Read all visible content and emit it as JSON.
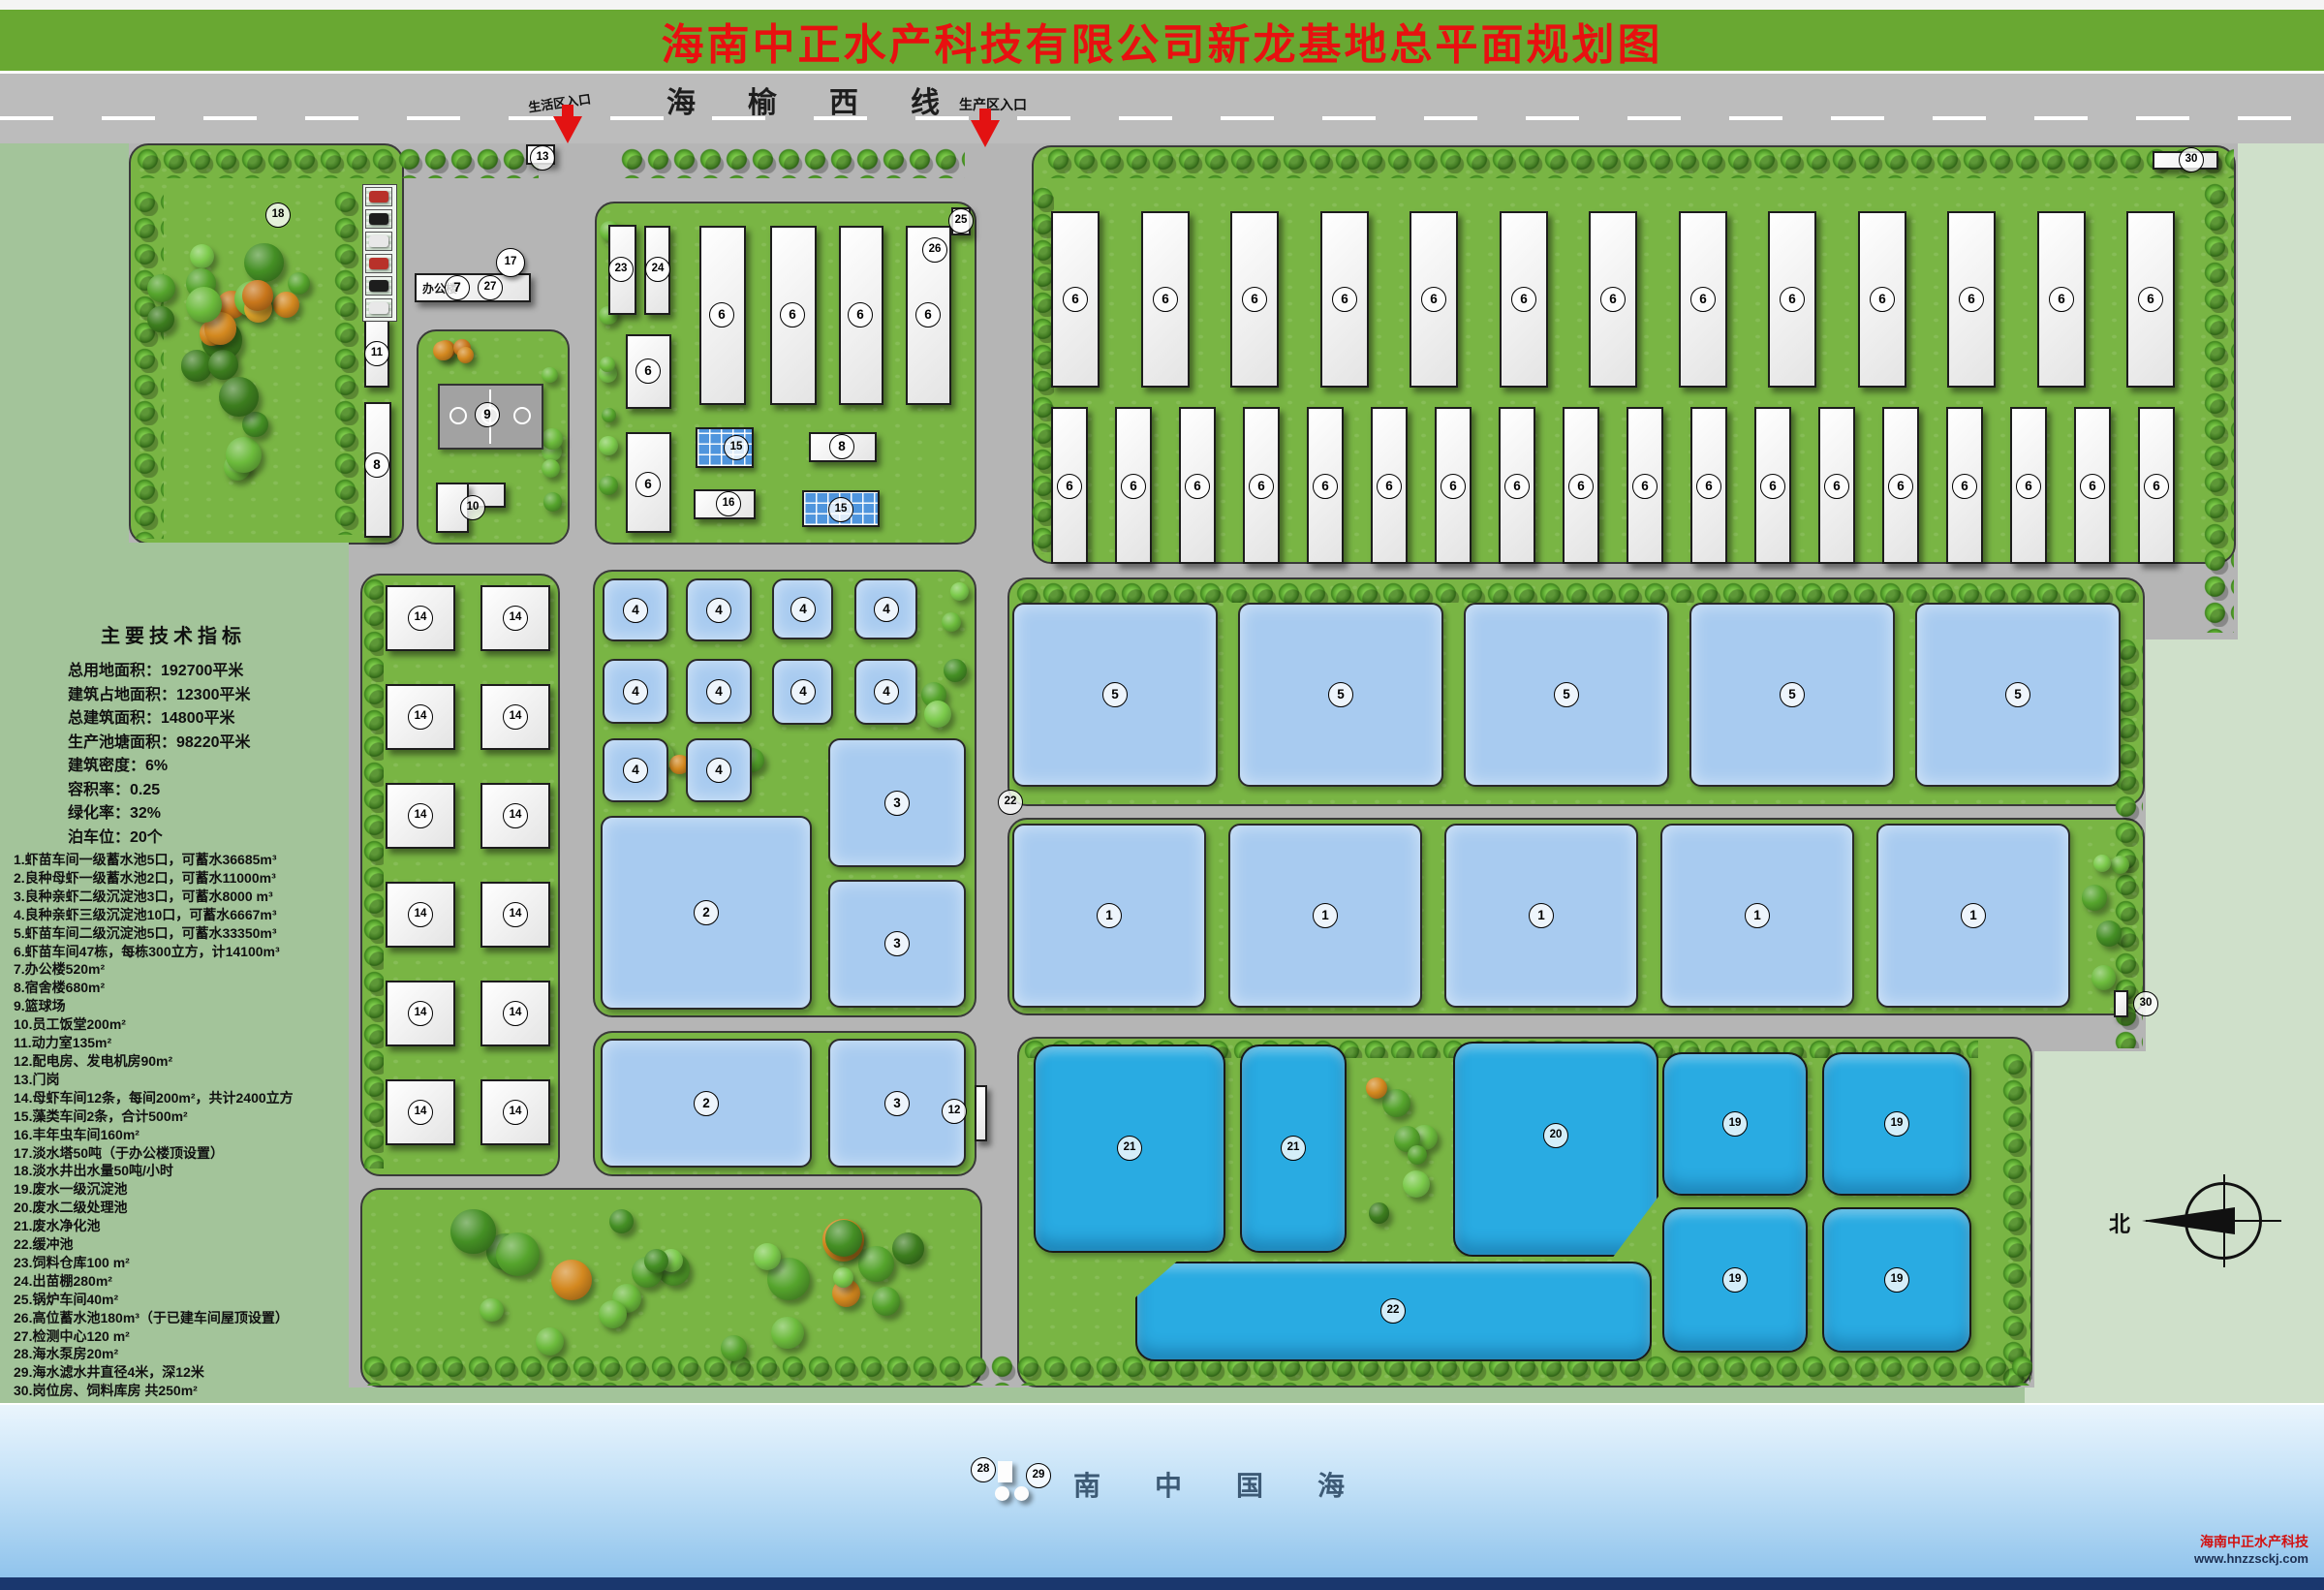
{
  "title": "海南中正水产科技有限公司新龙基地总平面规划图",
  "highway": {
    "name": "海榆西线",
    "entrance_living": "生活区入口",
    "entrance_production": "生产区入口"
  },
  "tech": {
    "title": "主要技术指标",
    "lines": [
      "总用地面积：192700平米",
      "建筑占地面积：12300平米",
      "总建筑面积：14800平米",
      "生产池塘面积：98220平米",
      "建筑密度：6%",
      "容积率：0.25",
      "绿化率：32%",
      "泊车位：20个"
    ]
  },
  "legend": [
    "1.虾苗车间一级蓄水池5口，可蓄水36685m³",
    "2.良种母虾一级蓄水池2口，可蓄水11000m³",
    "3.良种亲虾二级沉淀池3口，可蓄水8000 m³",
    "4.良种亲虾三级沉淀池10口，可蓄水6667m³",
    "5.虾苗车间二级沉淀池5口，可蓄水33350m³",
    "6.虾苗车间47栋，每栋300立方，计14100m³",
    "7.办公楼520m²",
    "8.宿舍楼680m²",
    "9.篮球场",
    "10.员工饭堂200m²",
    "11.动力室135m²",
    "12.配电房、发电机房90m²",
    "13.门岗",
    "14.母虾车间12条，每间200m²，共计2400立方",
    "15.藻类车间2条，合计500m²",
    "16.丰年虫车间160m²",
    "17.淡水塔50吨（于办公楼顶设置）",
    "18.淡水井出水量50吨/小时",
    "19.废水一级沉淀池",
    "20.废水二级处理池",
    "21.废水净化池",
    "22.缓冲池",
    "23.饲料仓库100 m²",
    "24.出苗棚280m²",
    "25.锅炉车间40m²",
    "26.高位蓄水池180m³（于已建车间屋顶设置）",
    "27.检测中心120 m²",
    "28.海水泵房20m²",
    "29.海水滤水井直径4米，深12米",
    "30.岗位房、饲料库房 共250m²"
  ],
  "labels": {
    "office": "办公楼",
    "sea": "南中国海",
    "north": "北"
  },
  "footer": {
    "company": "海南中正水产科技",
    "website": "www.hnzzsckj.com"
  },
  "colors": {
    "band": "#69a832",
    "title": "#e81010",
    "road": "#bcbcbc",
    "grass": "#79b544",
    "pond": "#a8cbf0",
    "cyan": "#29abe2",
    "sage": "#a3c49a",
    "sage2": "#cfe0ca",
    "navy": "#1a376e"
  },
  "markers": [
    [
      18,
      287,
      222
    ],
    [
      13,
      560,
      163
    ],
    [
      17,
      527,
      271
    ],
    [
      7,
      472,
      297
    ],
    [
      27,
      506,
      297
    ],
    [
      9,
      503,
      428
    ],
    [
      11,
      389,
      365
    ],
    [
      8,
      389,
      480
    ],
    [
      10,
      488,
      524
    ],
    [
      23,
      641,
      278
    ],
    [
      24,
      679,
      278
    ],
    [
      26,
      965,
      258
    ],
    [
      25,
      992,
      228
    ],
    [
      6,
      669,
      383
    ],
    [
      6,
      669,
      500
    ],
    [
      6,
      745,
      325
    ],
    [
      6,
      818,
      325
    ],
    [
      6,
      888,
      325
    ],
    [
      6,
      958,
      325
    ],
    [
      15,
      760,
      462
    ],
    [
      8,
      869,
      461
    ],
    [
      16,
      752,
      520
    ],
    [
      15,
      868,
      526
    ],
    [
      6,
      1110,
      309
    ],
    [
      6,
      1203,
      309
    ],
    [
      6,
      1295,
      309
    ],
    [
      6,
      1388,
      309
    ],
    [
      6,
      1480,
      309
    ],
    [
      6,
      1573,
      309
    ],
    [
      6,
      1665,
      309
    ],
    [
      6,
      1758,
      309
    ],
    [
      6,
      1850,
      309
    ],
    [
      6,
      1943,
      309
    ],
    [
      6,
      2035,
      309
    ],
    [
      6,
      2128,
      309
    ],
    [
      6,
      2220,
      309
    ],
    [
      6,
      1104,
      502
    ],
    [
      6,
      1170,
      502
    ],
    [
      6,
      1236,
      502
    ],
    [
      6,
      1302,
      502
    ],
    [
      6,
      1368,
      502
    ],
    [
      6,
      1434,
      502
    ],
    [
      6,
      1500,
      502
    ],
    [
      6,
      1566,
      502
    ],
    [
      6,
      1632,
      502
    ],
    [
      6,
      1698,
      502
    ],
    [
      6,
      1764,
      502
    ],
    [
      6,
      1830,
      502
    ],
    [
      6,
      1896,
      502
    ],
    [
      6,
      1962,
      502
    ],
    [
      6,
      2028,
      502
    ],
    [
      6,
      2094,
      502
    ],
    [
      6,
      2160,
      502
    ],
    [
      6,
      2226,
      502
    ],
    [
      4,
      656,
      630
    ],
    [
      4,
      742,
      630
    ],
    [
      4,
      829,
      629
    ],
    [
      4,
      915,
      629
    ],
    [
      4,
      656,
      714
    ],
    [
      4,
      742,
      714
    ],
    [
      4,
      829,
      714
    ],
    [
      4,
      915,
      714
    ],
    [
      4,
      656,
      795
    ],
    [
      4,
      742,
      795
    ],
    [
      14,
      434,
      638
    ],
    [
      14,
      532,
      638
    ],
    [
      14,
      434,
      740
    ],
    [
      14,
      532,
      740
    ],
    [
      14,
      434,
      842
    ],
    [
      14,
      532,
      842
    ],
    [
      14,
      434,
      944
    ],
    [
      14,
      532,
      944
    ],
    [
      14,
      434,
      1046
    ],
    [
      14,
      532,
      1046
    ],
    [
      14,
      434,
      1148
    ],
    [
      14,
      532,
      1148
    ],
    [
      2,
      729,
      942
    ],
    [
      3,
      926,
      829
    ],
    [
      3,
      926,
      974
    ],
    [
      2,
      729,
      1139
    ],
    [
      3,
      926,
      1139
    ],
    [
      12,
      985,
      1147
    ],
    [
      5,
      1151,
      717
    ],
    [
      5,
      1384,
      717
    ],
    [
      5,
      1617,
      717
    ],
    [
      5,
      1850,
      717
    ],
    [
      5,
      2083,
      717
    ],
    [
      1,
      1145,
      945
    ],
    [
      1,
      1368,
      945
    ],
    [
      1,
      1591,
      945
    ],
    [
      1,
      1814,
      945
    ],
    [
      1,
      2037,
      945
    ],
    [
      22,
      1043,
      828
    ],
    [
      21,
      1166,
      1185
    ],
    [
      21,
      1335,
      1185
    ],
    [
      20,
      1606,
      1172
    ],
    [
      19,
      1791,
      1160
    ],
    [
      19,
      1958,
      1160
    ],
    [
      19,
      1791,
      1321
    ],
    [
      19,
      1958,
      1321
    ],
    [
      22,
      1438,
      1353
    ],
    [
      28,
      1015,
      1517
    ],
    [
      29,
      1072,
      1523
    ],
    [
      30,
      2262,
      165
    ],
    [
      30,
      2215,
      1036
    ]
  ]
}
